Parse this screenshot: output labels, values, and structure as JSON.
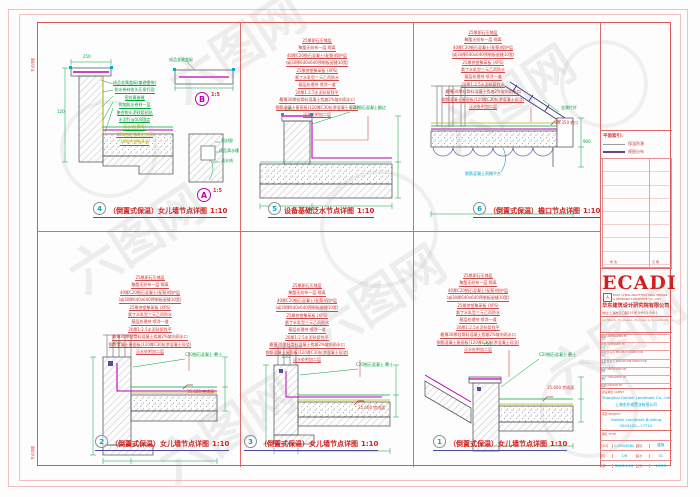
{
  "frame": {
    "margin_note": "节点详图"
  },
  "watermark": {
    "text": "六图网"
  },
  "titleblock": {
    "logo": "ECADI",
    "logo_mark": "A",
    "logo_sub1": "EAST CHINA ARCHITECTURAL DESIGN",
    "logo_sub2": "& RESEARCH INSTITUTE CO., LTD.",
    "company_cn": "华东建筑设计研究院有限公司",
    "address": "地址:上海市汉口路151号  0·6·0·1·0·8·1",
    "tagline": "Architects, Engineers, Planners & Consultants, Inc.",
    "legend_title": "平面索引:",
    "legend": [
      {
        "label": "保温防潮"
      },
      {
        "label": "视图分布"
      }
    ],
    "revision_note_left": "修 改",
    "revision_note_right": "日 期",
    "fields": [
      {
        "label": "审定 APPROVED BY",
        "sig": "TT"
      },
      {
        "label": "审核 CHECKED BY",
        "sig": "TT"
      },
      {
        "label": "项目负责人 PROJECT DIRECTOR",
        "sig": "TT"
      },
      {
        "label": "专业负责人 DISCIPLINE DIRECTOR",
        "sig": "TT"
      },
      {
        "label": "校对 REVIEWED BY",
        "sig": "TT"
      },
      {
        "label": "设计 DESIGNED BY",
        "sig": "TT"
      },
      {
        "label": "制图 DRAWN BY",
        "sig": "TT"
      }
    ],
    "client_label": "建设单位 CLIENT",
    "client_en": "Shanghai Golden Landmark Co., Ltd",
    "client_cn": "上海金外滩置业有限公司",
    "project_label": "项目 PROJECT",
    "project_en": "Golden Landmark Building",
    "project_no": "2004102—17710",
    "drawing_title_label": "图名 TITLE",
    "grid": {
      "r1": {
        "l1": "合同号",
        "v1": "C-0904062",
        "l2": "图别",
        "v2": "建施"
      },
      "r2": {
        "l1": "图号",
        "v1": "1/6",
        "l2": "版次",
        "v2": "01"
      },
      "r3": {
        "l1": "日期",
        "v1": "2004.1.10",
        "l2": "比例",
        "v2": "04.25"
      }
    }
  },
  "layers_roof": [
    "25厚卵石压铺层",
    "聚酯无纺布一层 隔离",
    "40厚C20细石混凝土(配筋)保护层",
    "(或30厚640x640预制板留缝10宽)",
    "25厚挤塑聚苯板 (XPS)",
    "氯丁水乳型三元乙丙防水",
    "基层处理剂 喷涂一道",
    "20厚1:2.5水泥砂浆找平",
    "最薄30厚轻骨料混凝土找坡2%坡向雨水口",
    "钢筋混凝土屋面板(120厚C30抗渗混凝土现浇)",
    "泛水处附加二层"
  ],
  "layers_d4": [
    {
      "t": "成品金属盖板(兼避雷带)",
      "c": "#00a33e"
    },
    {
      "t": "防水卷材收头压条钉固",
      "c": "#00a33e"
    },
    {
      "t": "密封膏嵌缝",
      "c": "#00a33e"
    },
    {
      "t": "附加防水卷材一层",
      "c": "#00a33e"
    },
    {
      "t": "聚合物水泥砂浆粘贴",
      "c": "#00a33e"
    },
    {
      "t": "水泥钉@500固定",
      "c": "#00a33e"
    },
    {
      "t": "滴水线(鹰嘴)",
      "c": "#b5b500"
    },
    {
      "t": "C20细石混凝土压顶",
      "c": "#b5b500"
    },
    {
      "t": "30厚挤塑聚苯板",
      "c": "#b5b500"
    }
  ],
  "details": [
    {
      "num": "4",
      "title": "（倒置式保温）女儿墙节点详图",
      "scale": "1:10",
      "sub_b": "B",
      "sub_b_scale": "1:5",
      "sub_a": "A",
      "sub_a_scale": "1:5",
      "annotations": [
        {
          "t": "成品金属盖板",
          "x": 132,
          "y": 36
        },
        {
          "t": "250",
          "x": 46,
          "y": 33
        },
        {
          "t": "密封胶",
          "x": 184,
          "y": 117
        },
        {
          "t": "成品滴水槽",
          "x": 182,
          "y": 127
        },
        {
          "t": "滴水线",
          "x": 184,
          "y": 137
        },
        {
          "t": "120",
          "x": 20,
          "y": 88
        }
      ]
    },
    {
      "num": "5",
      "title": "设备基础泛水节点详图",
      "scale": "1:10",
      "annotations": [
        {
          "t": "C20细石混凝土翻边",
          "x": 110,
          "y": 84,
          "w": 46
        },
        {
          "t": "600",
          "x": 66,
          "y": 186
        },
        {
          "t": "120",
          "x": 44,
          "y": 86
        }
      ]
    },
    {
      "num": "6",
      "title": "（倒置式保温）檐口节点详图",
      "scale": "1:10",
      "annotations": [
        {
          "t": "金属栏杆",
          "x": 148,
          "y": 84
        },
        {
          "t": "38.350 檐口",
          "x": 142,
          "y": 99,
          "c": "#d03030"
        },
        {
          "t": "钢筋混凝土雨棚平台",
          "x": 52,
          "y": 150,
          "c": "#00aac8"
        },
        {
          "t": "900",
          "x": 170,
          "y": 118
        }
      ]
    },
    {
      "num": "2",
      "title": "（倒置式保温）女儿墙节点详图",
      "scale": "1:10",
      "annotations": [
        {
          "t": "C20细石混凝土 覆土",
          "x": 148,
          "y": 122,
          "w": 46
        },
        {
          "t": "35.600 完成面",
          "x": 150,
          "y": 159,
          "c": "#d03030"
        },
        {
          "t": "250",
          "x": 76,
          "y": 110
        }
      ]
    },
    {
      "num": "3",
      "title": "（倒置式保温）女儿墙节点详图",
      "scale": "1:10",
      "annotations": [
        {
          "t": "C20细石混凝土 覆土",
          "x": 116,
          "y": 132,
          "w": 46
        },
        {
          "t": "35.600 完成面",
          "x": 118,
          "y": 175,
          "c": "#d03030"
        },
        {
          "t": "250",
          "x": 42,
          "y": 124
        }
      ]
    },
    {
      "num": "1",
      "title": "（倒置式保温）女儿墙节点详图",
      "scale": "1:10",
      "annotations": [
        {
          "t": "C20细石混凝土 覆土",
          "x": 126,
          "y": 122,
          "w": 46
        },
        {
          "t": "35.600 完成面",
          "x": 134,
          "y": 155,
          "c": "#d03030"
        },
        {
          "t": "250",
          "x": 70,
          "y": 112
        }
      ]
    }
  ]
}
